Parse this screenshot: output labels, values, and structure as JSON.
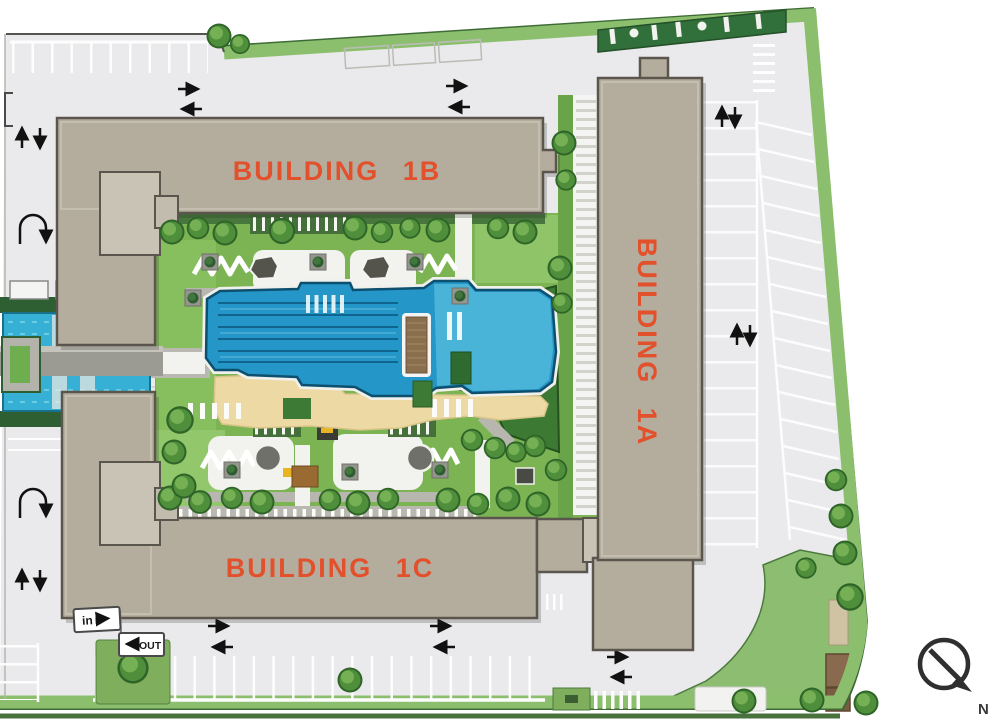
{
  "plan": {
    "buildings": [
      {
        "id": "1B",
        "label": "BUILDING 1B"
      },
      {
        "id": "1A",
        "label": "BUILDING 1A"
      },
      {
        "id": "1C",
        "label": "BUILDING 1C"
      }
    ],
    "signs": {
      "entry": "in",
      "exit": "OUT"
    },
    "compass": {
      "north": "N"
    },
    "colors": {
      "label_orange": "#e2502c",
      "building_fill": "#b4ad9e",
      "building_outline": "#5a564d",
      "pavement": "#eaeaec",
      "boundary_green": "#8cbf6d",
      "lawn": "#7cb454",
      "lawn_dark": "#3c7a33",
      "pool_blue": "#2596c8",
      "pool_light": "#49b4d8",
      "sand_deck": "#ecd9a4",
      "water_canal": "#36b0d4"
    }
  }
}
